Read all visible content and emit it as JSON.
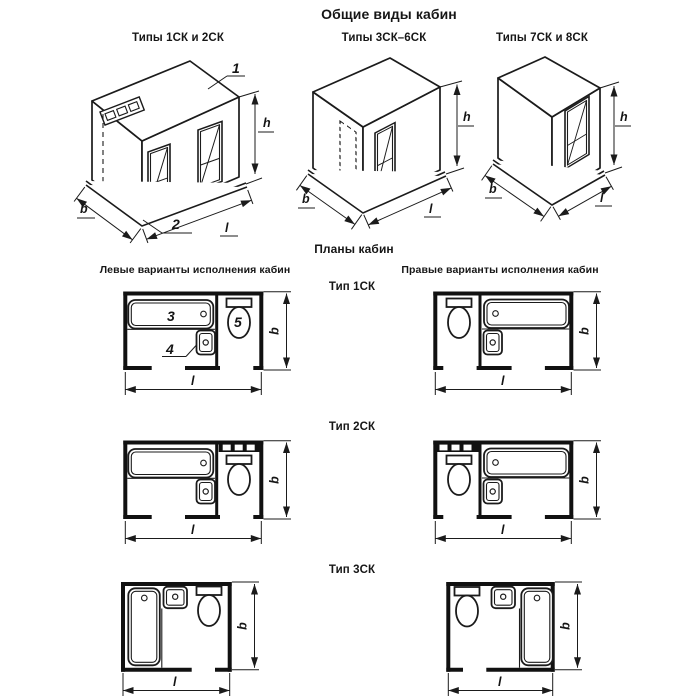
{
  "title": "Общие виды кабин",
  "general_views": {
    "cabins": [
      {
        "label": "Типы 1СК и 2СК"
      },
      {
        "label": "Типы 3СК–6СК"
      },
      {
        "label": "Типы 7СК и 8СК"
      }
    ],
    "callouts": {
      "roof_panel": "1",
      "floor_panel": "2"
    }
  },
  "plans": {
    "title": "Планы кабин",
    "left_column_header": "Левые варианты исполнения кабин",
    "right_column_header": "Правые варианты исполнения кабин",
    "rows": [
      {
        "label": "Тип 1СК"
      },
      {
        "label": "Тип 2СК"
      },
      {
        "label": "Тип 3СК"
      }
    ],
    "callouts": {
      "bath": "3",
      "washbasin": "4",
      "toilet_bowl": "5"
    }
  },
  "dimension_labels": {
    "width": "b",
    "length": "l",
    "height": "h"
  },
  "colors": {
    "line": "#1b1b1b",
    "background": "#ffffff"
  }
}
